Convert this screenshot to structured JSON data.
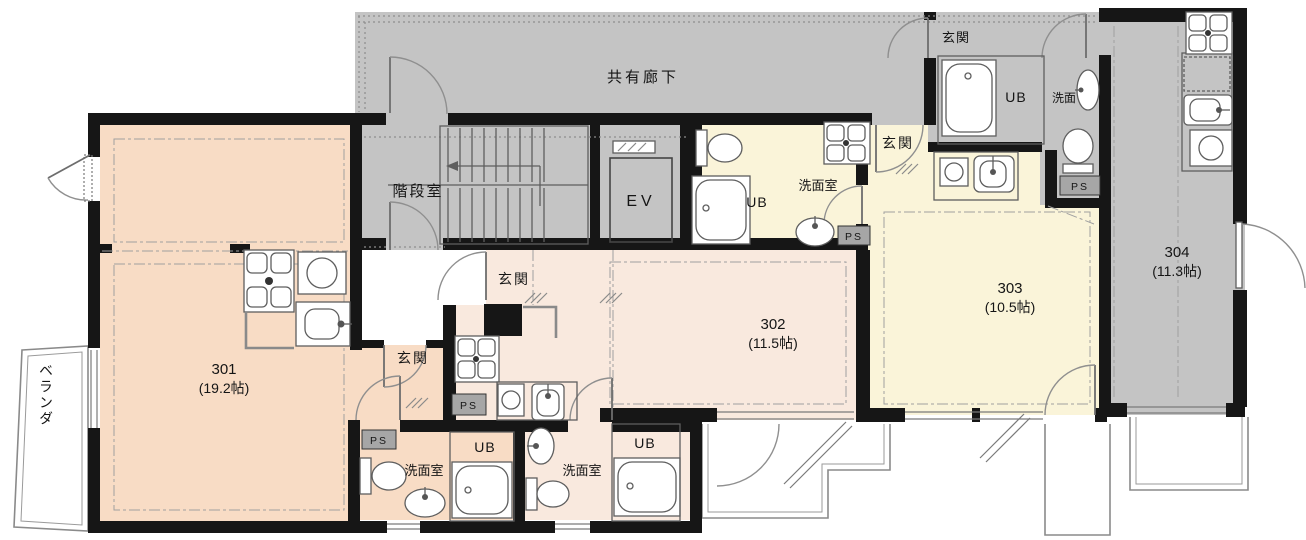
{
  "floorplan": {
    "common_labels": {
      "corridor": "共有廊下",
      "stairwell": "階段室",
      "elevator": "EV",
      "veranda": "ベランダ"
    },
    "room_labels": {
      "entrance": "玄関",
      "washroom": "洗面室",
      "washbasin": "洗面",
      "unit_bath": "UB",
      "pipe_space": "PS"
    },
    "units": [
      {
        "number": "301",
        "size": "(19.2帖)"
      },
      {
        "number": "302",
        "size": "(11.5帖)"
      },
      {
        "number": "303",
        "size": "(10.5帖)"
      },
      {
        "number": "304",
        "size": "(11.3帖)"
      }
    ],
    "colors": {
      "unit_301_fill": "#f8dcc5",
      "unit_302_fill": "#f9e9de",
      "unit_303_fill": "#faf4d9",
      "common_area_fill": "#c4c4c4",
      "pipe_space_fill": "#a6a6a6",
      "wall": "#161616"
    }
  }
}
